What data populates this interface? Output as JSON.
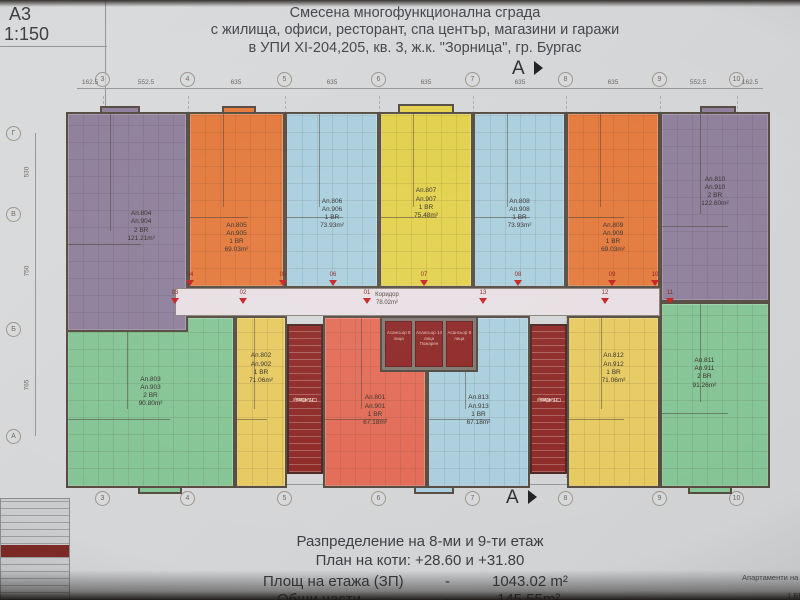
{
  "sheet": {
    "format": "А3",
    "scale": "1:150"
  },
  "title": {
    "line1": "Смесена многофункционална сграда",
    "line2": "с жилища, офиси, ресторант, спа център, магазини и  гаражи",
    "line3": "в УПИ XI-204,205, кв. 3, ж.к. \"Зорница\", гр. Бургас"
  },
  "grid": {
    "top_bubbles": [
      "3",
      "4",
      "5",
      "6",
      "7",
      "8",
      "9",
      "10"
    ],
    "top_dims": [
      "162.5",
      "552.5",
      "635",
      "635",
      "635",
      "635",
      "635",
      "552.5",
      "162.5"
    ],
    "left_bubbles": [
      "Г",
      "В",
      "Б",
      "А"
    ],
    "left_dims": [
      "530",
      "750",
      "765"
    ],
    "section_letter": "А"
  },
  "corridor": {
    "name": "Коридор",
    "area": "78.02m²"
  },
  "apartments": [
    {
      "id_lower": "Ап.804",
      "id_upper": "Ап.904",
      "rooms": "2 BR",
      "area": "121.21m²",
      "color": "purple"
    },
    {
      "id_lower": "Ап.805",
      "id_upper": "Ап.905",
      "rooms": "1 BR",
      "area": "69.03m²",
      "color": "orange"
    },
    {
      "id_lower": "Ап.806",
      "id_upper": "Ап.906",
      "rooms": "1 BR",
      "area": "73.93m²",
      "color": "cyan"
    },
    {
      "id_lower": "Ап.807",
      "id_upper": "Ап.907",
      "rooms": "1 BR",
      "area": "75.48m²",
      "color": "yellow"
    },
    {
      "id_lower": "Ап.808",
      "id_upper": "Ап.908",
      "rooms": "1 BR",
      "area": "73.93m²",
      "color": "cyan"
    },
    {
      "id_lower": "Ап.809",
      "id_upper": "Ап.909",
      "rooms": "1 BR",
      "area": "69.03m²",
      "color": "orange"
    },
    {
      "id_lower": "Ап.810",
      "id_upper": "Ап.910",
      "rooms": "2 BR",
      "area": "122.60m²",
      "color": "purple"
    },
    {
      "id_lower": "Ап.803",
      "id_upper": "Ап.903",
      "rooms": "2 BR",
      "area": "90.80m²",
      "color": "green"
    },
    {
      "id_lower": "Ап.802",
      "id_upper": "Ап.902",
      "rooms": "1 BR",
      "area": "71.06m²",
      "color": "yellow"
    },
    {
      "id_lower": "Ап.801",
      "id_upper": "Ап.901",
      "rooms": "1 BR",
      "area": "67.18m²",
      "color": "salmon"
    },
    {
      "id_lower": "Ап.813",
      "id_upper": "Ап.913",
      "rooms": "1 BR",
      "area": "67.18m²",
      "color": "cyan"
    },
    {
      "id_lower": "Ап.812",
      "id_upper": "Ап.912",
      "rooms": "1 BR",
      "area": "71.06m²",
      "color": "yellow"
    },
    {
      "id_lower": "Ап.811",
      "id_upper": "Ап.911",
      "rooms": "2 BR",
      "area": "91.26m²",
      "color": "green"
    }
  ],
  "cores": {
    "stair_name": "Стълбище",
    "stair_area": "22.42m²",
    "elevator_side": "Асансьор 8 лица",
    "elevator_mid": "Асансьор 14 лица",
    "elevator_mid2": "Пожарен"
  },
  "entrances": {
    "top": [
      "04",
      "05",
      "06",
      "07",
      "08",
      "09",
      "10"
    ],
    "bottom": [
      "03",
      "02",
      "01",
      "13",
      "12",
      "11"
    ]
  },
  "footer": {
    "line1": "Разпределение на 8-ми и 9-ти етаж",
    "line2": "План на коти: +28.60 и +31.80",
    "area_label": "Площ на етажа (ЗП)",
    "area_dash": "-",
    "area_value": "1043.02 m²",
    "common_label": "Общи части",
    "common_dash": "-",
    "common_value": "145.55m²",
    "corner_note": "Апартаменти на",
    "corner_note2": "1 BR:"
  },
  "colors": {
    "purple": "#8e7e9a",
    "orange": "#e4783a",
    "cyan": "#a9cedd",
    "yellow_center": "#e2d049",
    "yellow": "#e6c95f",
    "green": "#84c494",
    "salmon": "#e26a55",
    "dark_red": "#8d2725",
    "corridor": "#e7dfe3",
    "wall": "#544a40",
    "arrow_red": "#c42020",
    "paper": "#d4d6d8"
  }
}
